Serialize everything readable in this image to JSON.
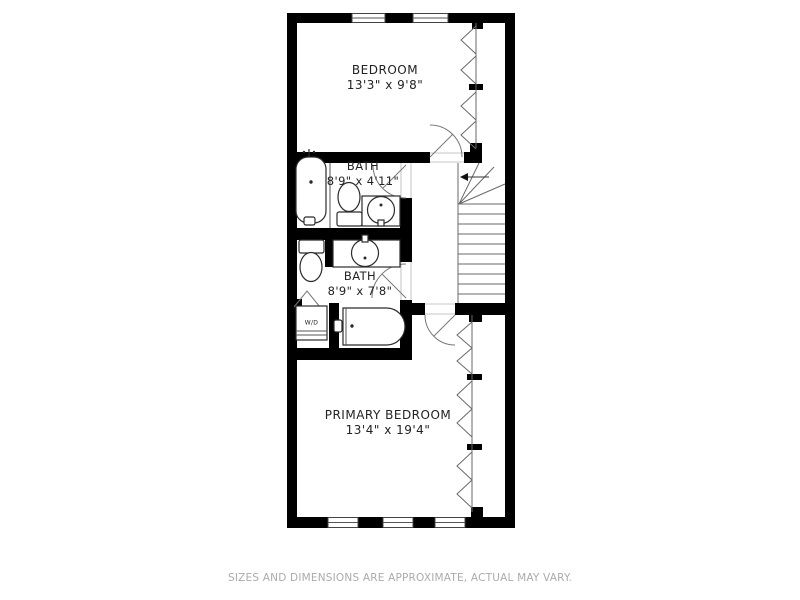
{
  "floorplan": {
    "rooms": [
      {
        "name": "BEDROOM",
        "dimensions": "13'3\" x 9'8\""
      },
      {
        "name": "BATH",
        "dimensions": "8'9\" x 4'11\""
      },
      {
        "name": "BATH",
        "dimensions": "8'9\" x 7'8\""
      },
      {
        "name": "PRIMARY BEDROOM",
        "dimensions": "13'4\" x 19'4\""
      }
    ],
    "closet_label": "W/D",
    "fixtures": [
      "bathtub",
      "toilet",
      "sink-vanity",
      "washer-dryer",
      "staircase",
      "windows",
      "doors"
    ],
    "colors": {
      "wall": "#000000",
      "line": "#6a6a6a",
      "room_text": "#222222",
      "footer_text": "#ababab",
      "background": "#ffffff"
    }
  },
  "footer": {
    "disclaimer": "SIZES AND DIMENSIONS ARE APPROXIMATE, ACTUAL MAY VARY."
  }
}
